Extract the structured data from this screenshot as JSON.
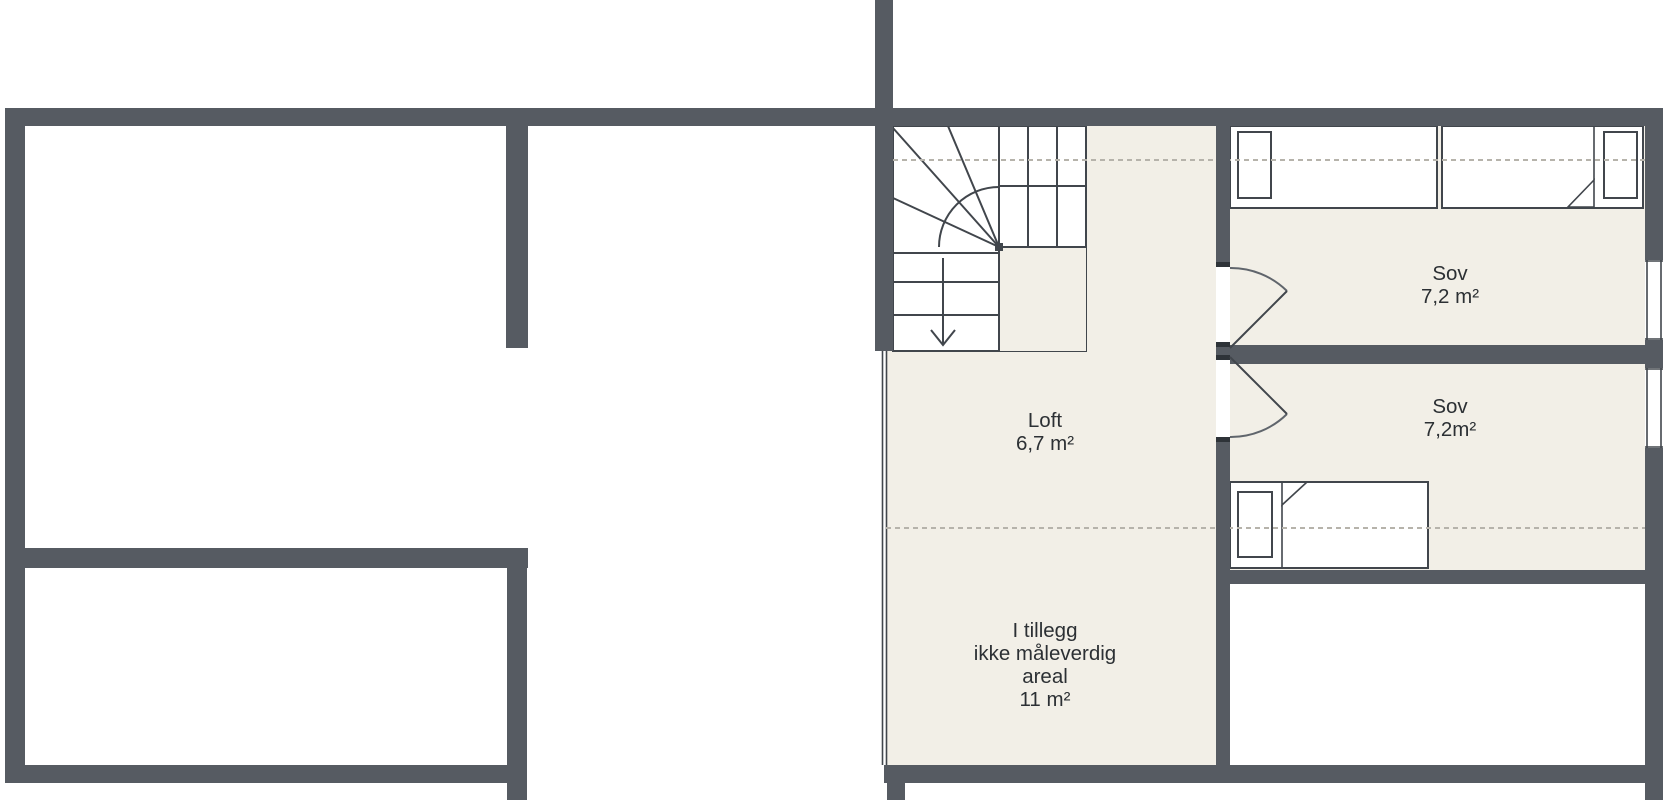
{
  "rooms": {
    "loft": {
      "name": "Loft",
      "area": "6,7 m²"
    },
    "bedroom_top": {
      "name": "Sov",
      "area": "7,2 m²"
    },
    "bedroom_bottom": {
      "name": "Sov",
      "area": "7,2m²"
    },
    "additional_area": {
      "line1": "I tillegg",
      "line2": "ikke måleverdig",
      "line3": "areal",
      "line4": "11 m²"
    }
  },
  "colors": {
    "wall": "#565b62",
    "cap": "#2e3338",
    "floor": "#f2efe7",
    "line": "#41464c",
    "arc": "#60656c",
    "dash": "#b6b3ab",
    "text": "#2c3034",
    "background": "#ffffff"
  }
}
